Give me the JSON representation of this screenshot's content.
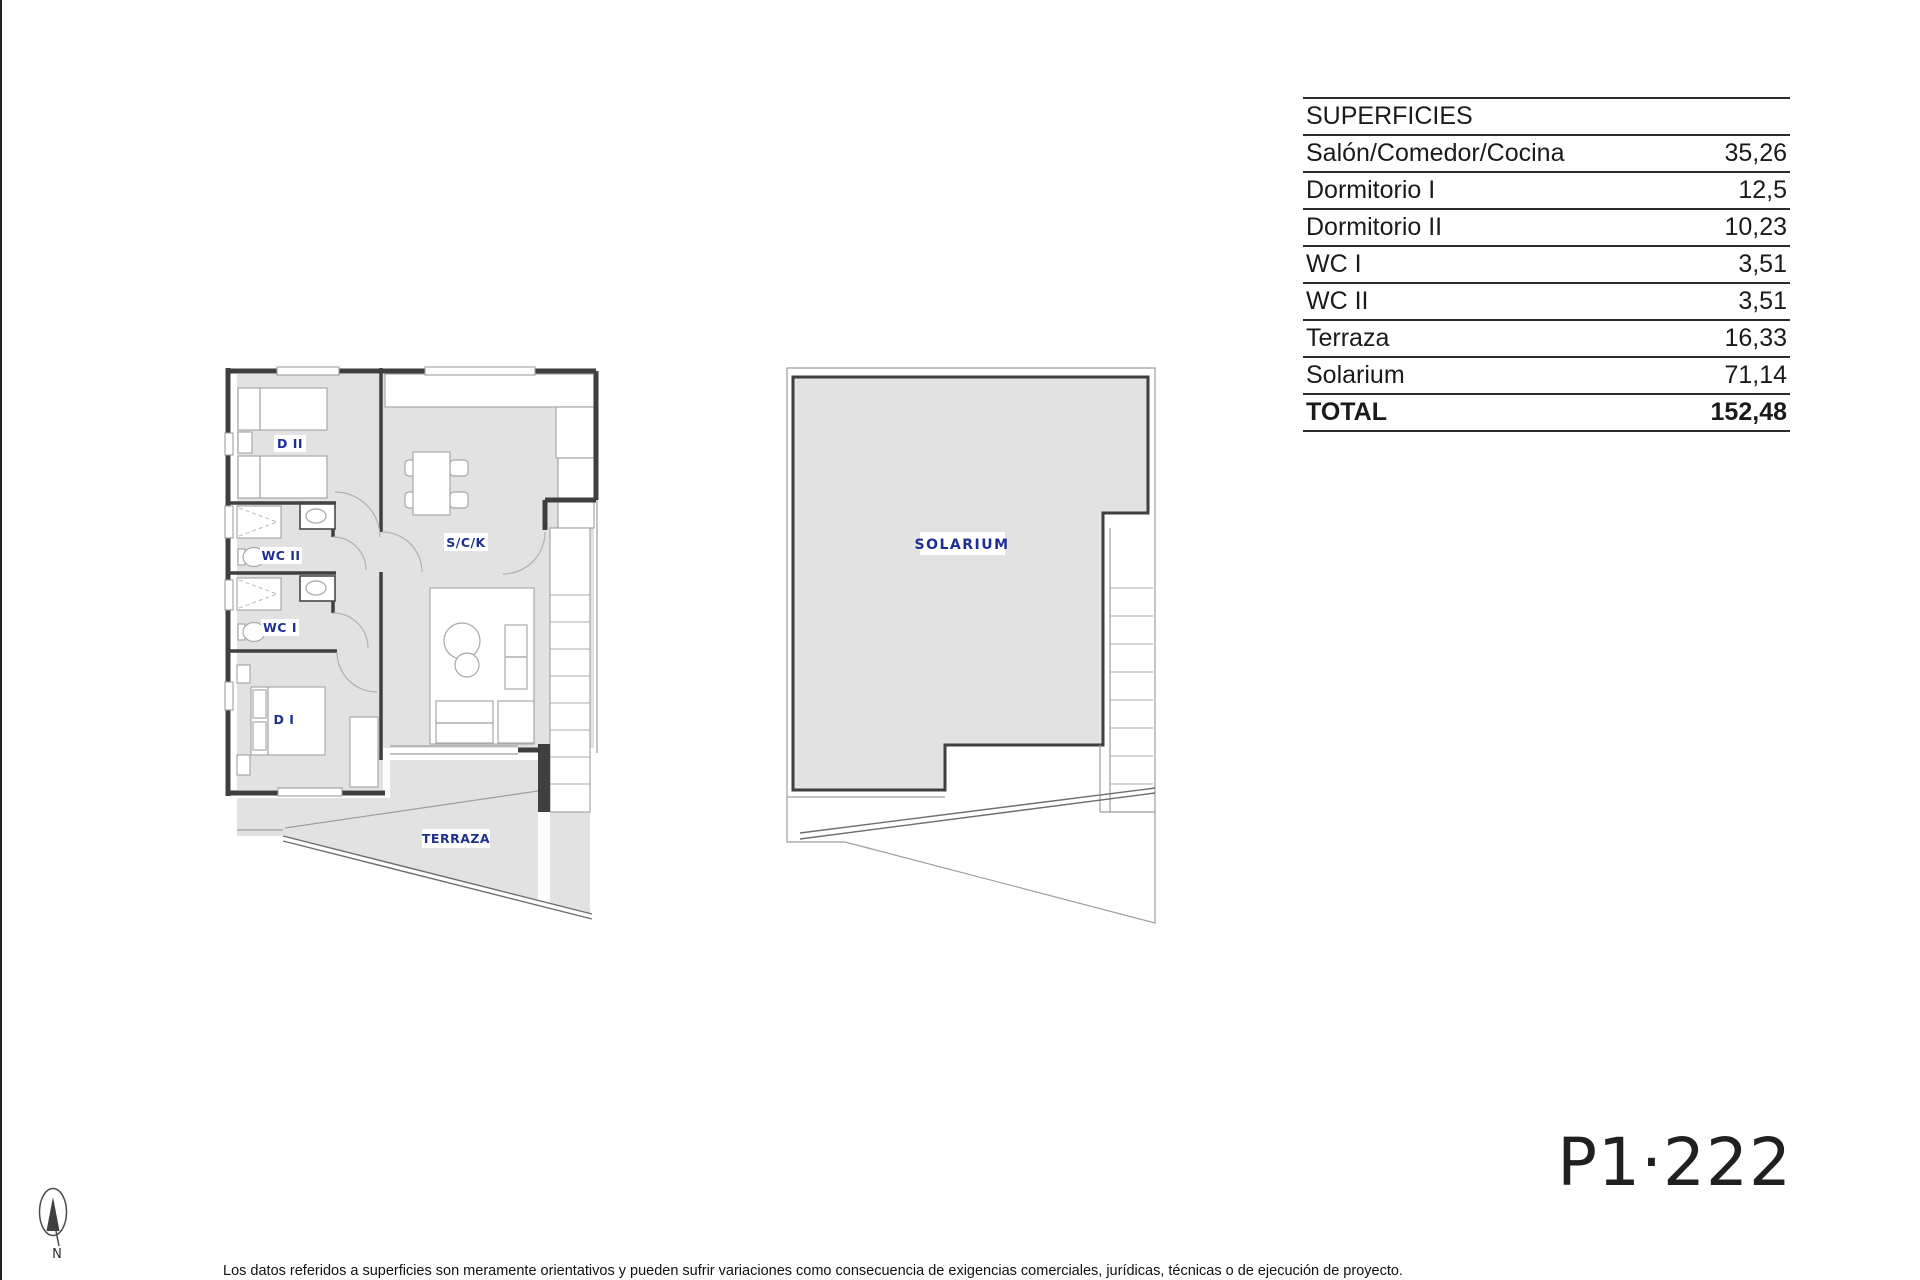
{
  "page": {
    "sheet_code": "P1·222",
    "disclaimer": "Los datos referidos a superficies son meramente orientativos y pueden sufrir variaciones como consecuencia de exigencias comerciales, jurídicas, técnicas o de ejecución de proyecto.",
    "compass_label": "N"
  },
  "table": {
    "title": "SUPERFICIES",
    "rows": [
      {
        "label": "Salón/Comedor/Cocina",
        "value": "35,26"
      },
      {
        "label": "Dormitorio I",
        "value": "12,5"
      },
      {
        "label": "Dormitorio II",
        "value": "10,23"
      },
      {
        "label": "WC I",
        "value": "3,51"
      },
      {
        "label": "WC II",
        "value": "3,51"
      },
      {
        "label": "Terraza",
        "value": "16,33"
      },
      {
        "label": "Solarium",
        "value": "71,14"
      }
    ],
    "total": {
      "label": "TOTAL",
      "value": "152,48"
    }
  },
  "plans": {
    "apartment": {
      "labels": {
        "d2": "D II",
        "wc2": "WC II",
        "wc1": "WC I",
        "d1": "D I",
        "sck": "S/C/K",
        "terraza": "TERRAZA"
      }
    },
    "solarium": {
      "label": "SOLARIUM"
    }
  },
  "colors": {
    "floor_gray": "#e2e2e2",
    "wall_dark": "#3f3f3f",
    "label_navy": "#1d3092",
    "thin_line": "#9e9e9e"
  }
}
